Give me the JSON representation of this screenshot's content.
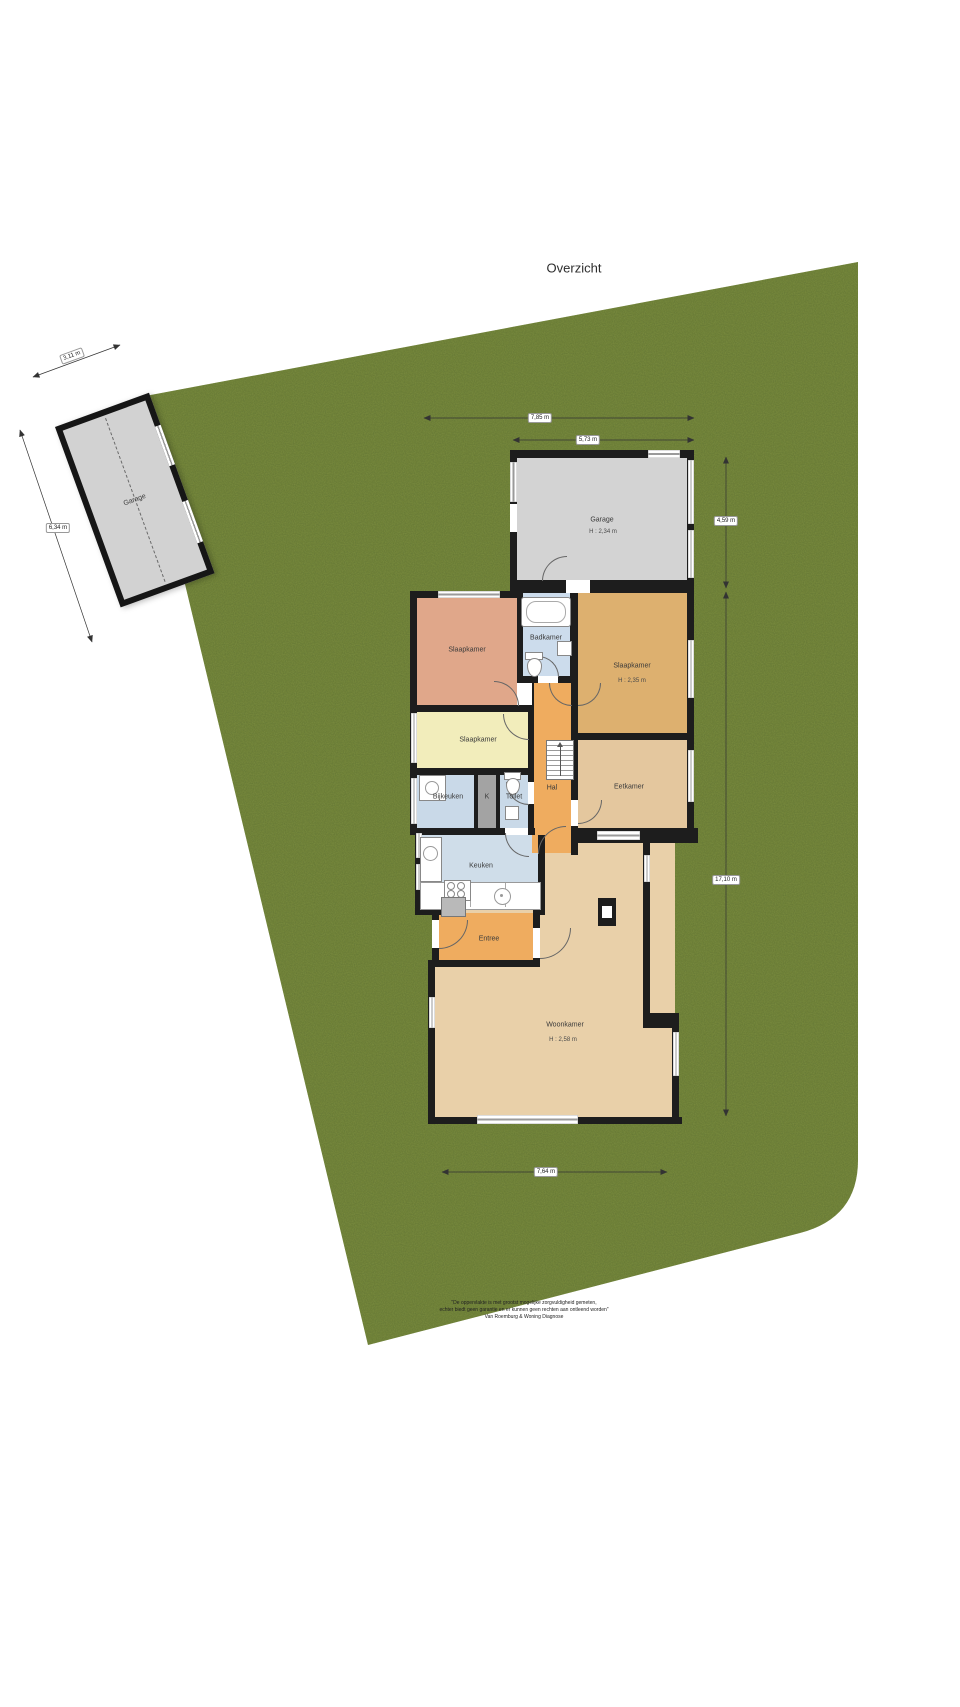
{
  "title": "Overzicht",
  "colors": {
    "grass": "#7b8d3f",
    "wall": "#1d1d1d",
    "garage-fill": "#d3d3d3",
    "bedroom-salmon": "#e0a78a",
    "bedroom-yellow": "#f2edbb",
    "bedroom-orange": "#ddb06f",
    "bath-blue": "#ccdcec",
    "utility-blue": "#c9d9e8",
    "kitchen-blue": "#cfdde9",
    "hall-orange": "#efac5f",
    "dining-tan": "#e4c79e",
    "living-tan": "#e9d0a9",
    "closet-gray": "#a3a3a3"
  },
  "rooms": {
    "garage_detached": {
      "label": "Garage"
    },
    "garage": {
      "label": "Garage",
      "height": "H : 2,34 m"
    },
    "slaapkamer_nw": {
      "label": "Slaapkamer"
    },
    "badkamer": {
      "label": "Badkamer"
    },
    "slaapkamer_ne": {
      "label": "Slaapkamer",
      "height": "H : 2,35 m"
    },
    "slaapkamer_mid": {
      "label": "Slaapkamer"
    },
    "bijkeuken": {
      "label": "Bijkeuken"
    },
    "kast": {
      "label": "K"
    },
    "toilet": {
      "label": "Toilet"
    },
    "hal": {
      "label": "Hal"
    },
    "eetkamer": {
      "label": "Eetkamer"
    },
    "keuken": {
      "label": "Keuken"
    },
    "entree": {
      "label": "Entree"
    },
    "woonkamer": {
      "label": "Woonkamer",
      "height": "H : 2,58 m"
    }
  },
  "dimensions": {
    "garage_detached_width": "3,11 m",
    "garage_detached_depth": "6,34 m",
    "house_width_total": "7,85 m",
    "garage_width": "5,73 m",
    "garage_depth": "4,59 m",
    "house_depth": "17,10 m",
    "house_width_bottom": "7,64 m"
  },
  "footer": {
    "line1": "\"De oppervlakte is met grootst mogelijke zorgvuldigheid gemeten,",
    "line2": "echter biedt geen garantie en er kunnen geen rechten aan ontleend worden\"",
    "line3": "Van Roemburg & Woning Diagnose"
  }
}
